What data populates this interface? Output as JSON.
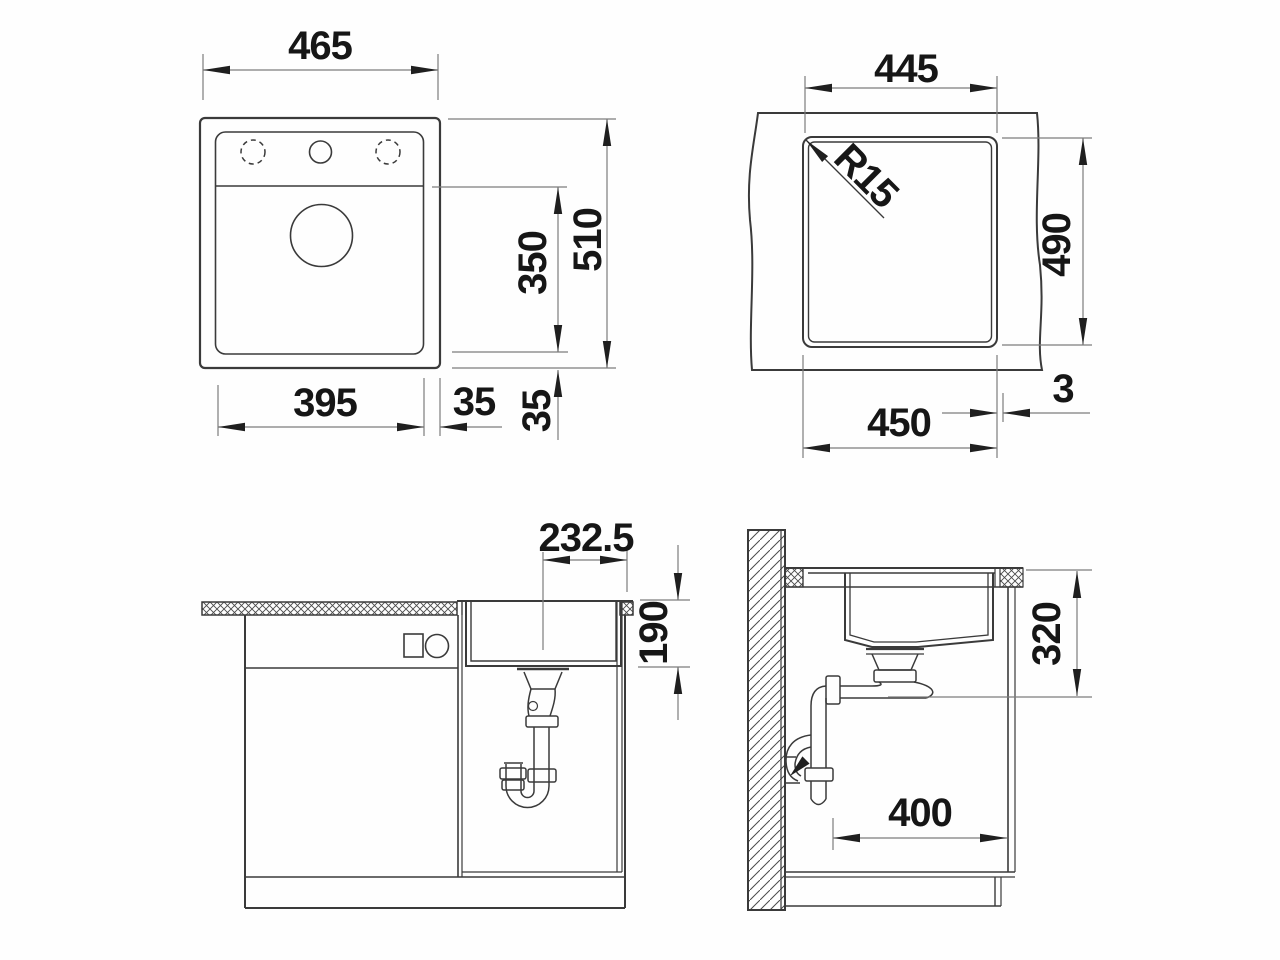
{
  "drawing": {
    "type": "technical-dimension-drawing",
    "subject": "kitchen sink installation drawing (4 views)",
    "colors": {
      "object_line": "#3a3a3a",
      "dimension_line": "#7d7d7d",
      "arrow": "#1f1f1f",
      "text": "#161616",
      "background": "#fefefe"
    },
    "views": {
      "top_plan": {
        "label": "sink top view",
        "dims": {
          "overall_width": "465",
          "overall_depth": "510",
          "bowl_section_depth": "350",
          "bowl_width": "395",
          "side_margin": "35",
          "bottom_margin": "35"
        }
      },
      "cutout_plan": {
        "label": "worktop cutout view",
        "dims": {
          "inner_width": "445",
          "cutout_depth": "490",
          "cutout_width": "450",
          "corner_radius": "R15",
          "edge_gap": "3"
        }
      },
      "front_section": {
        "label": "front section through cabinet",
        "dims": {
          "drain_center_offset": "232.5",
          "bowl_depth": "190"
        }
      },
      "side_section": {
        "label": "side section at wall",
        "dims": {
          "install_depth": "320",
          "base_clearance": "400"
        }
      }
    }
  }
}
